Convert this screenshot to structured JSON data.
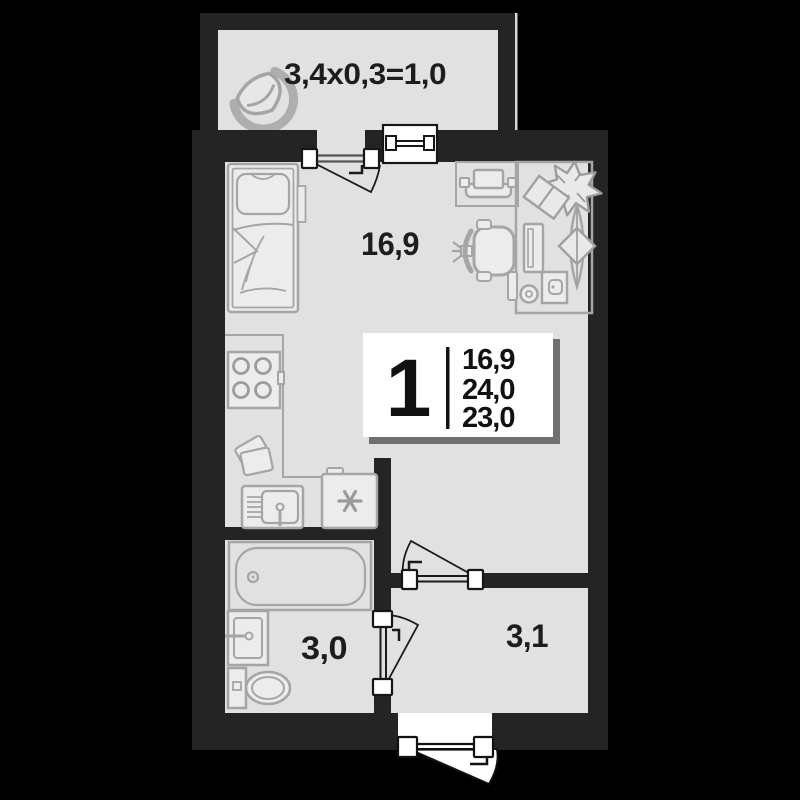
{
  "floorplan": {
    "balcony_label": "3,4x0,3=1,0",
    "room_label": "16,9",
    "bathroom_label": "3,0",
    "hallway_label": "3,1",
    "info_card": {
      "rooms": "1",
      "area_living": "16,9",
      "area_total": "24,0",
      "area_reduced": "23,0"
    },
    "colors": {
      "background": "#000000",
      "wall": "#242424",
      "floor": "#e1e1e1",
      "furniture_stroke": "#a5a5a5",
      "card": "#ffffff",
      "text": "#1d1d1d"
    }
  }
}
